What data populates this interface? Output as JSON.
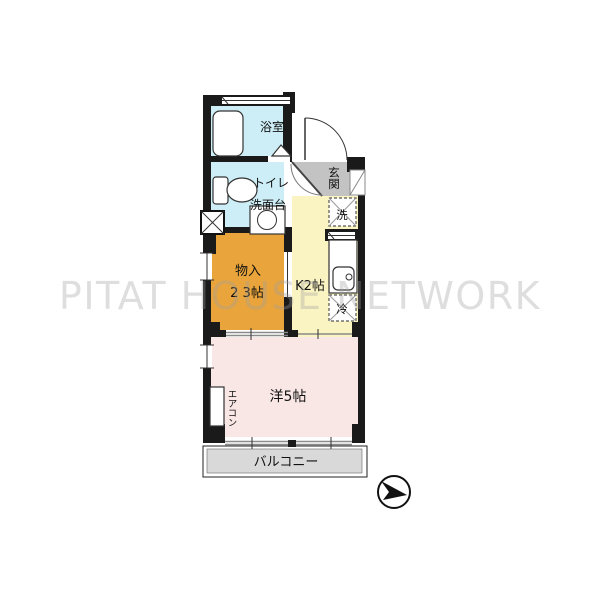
{
  "watermark": "PITAT HOUSE NETWORK",
  "floorplan": {
    "rooms": {
      "bath": {
        "label": "浴室"
      },
      "toilet": {
        "label_line1": "トイレ",
        "label_line2": "洗面台"
      },
      "entrance": {
        "label": "玄関"
      },
      "laundry": {
        "label": "洗"
      },
      "kitchen": {
        "label": "K2帖"
      },
      "fridge": {
        "label": "冷"
      },
      "storage": {
        "label": "物入",
        "size": "2 3帖"
      },
      "western_room": {
        "label": "洋5帖"
      },
      "aircon": {
        "label": "エアコン"
      },
      "balcony": {
        "label": "バルコニー"
      }
    },
    "colors": {
      "bath_blue": "#cdeef6",
      "storage_orange": "#e9a53c",
      "kitchen_yellow": "#faf3c2",
      "room_pink": "#f9e7e5",
      "entrance_gray": "#c3c3c3",
      "balcony_gray": "#d9d9d9",
      "wall_black": "#1a1a1a",
      "watermark_gray": "#e2e2e2"
    }
  }
}
